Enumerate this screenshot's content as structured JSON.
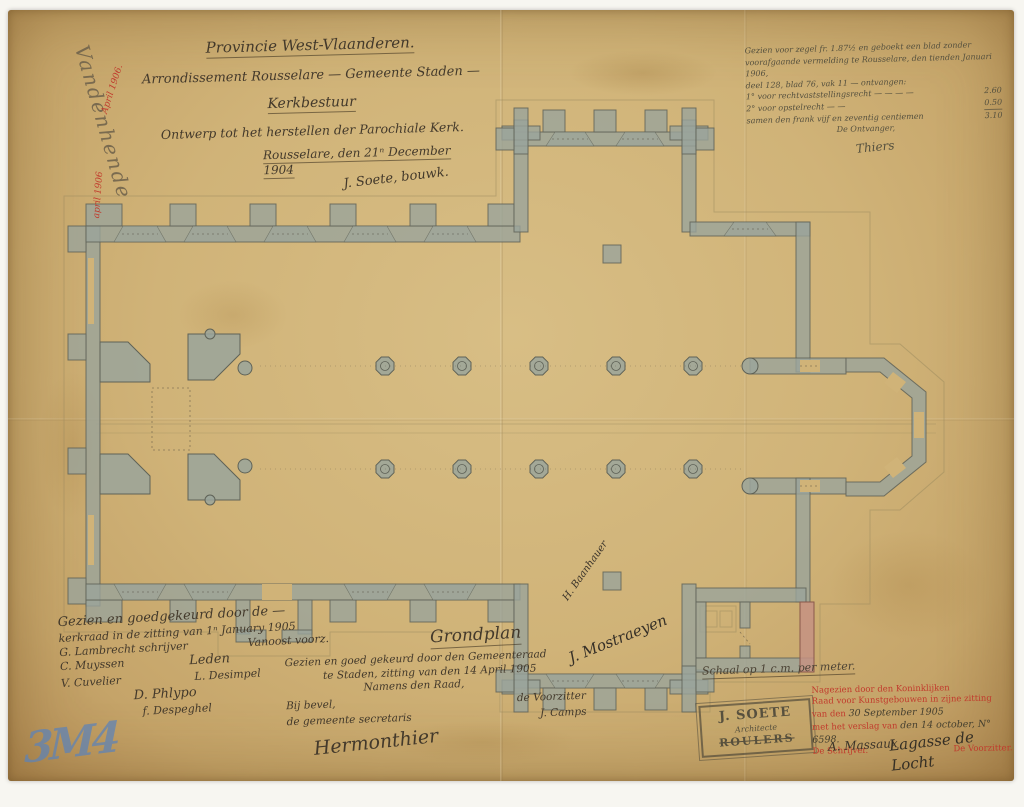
{
  "colors": {
    "paper": "#d0b378",
    "scan_border": "#f7f6f1",
    "wall_wash": "#9aa49b",
    "new_wall_red": "#c59282",
    "ink": "#43392b",
    "red_ink": "#c13a2c",
    "blue_crayon": "#5d83b8",
    "pencil": "#998a5e"
  },
  "title_block": {
    "province": "Provincie West-Vlaanderen.",
    "arrondissement": "Arrondissement Rousselare — Gemeente Staden —",
    "authority": "Kerkbestuur",
    "subject": "Ontwerp tot het herstellen der Parochiale Kerk.",
    "dateline": "Rousselare, den 21ⁿ December 1904",
    "architect_signature": "J. Soete, bouwk."
  },
  "registration_note": {
    "lines": [
      "Gezien voor zegel fr. 1.87½ en geboekt een blad zonder",
      "voorafgaande vermelding te Rousselare, den tienden Januari 1906,",
      "deel 128, blad 76, vak 11 — ontvangen:",
      "1° voor rechtvaststellingsrecht — — — —",
      "2° voor opstelrecht — —",
      "samen den frank vijf en zeventig centiemen",
      "De Ontvanger,"
    ],
    "amounts": [
      "2.60",
      "0.50",
      "3.10"
    ],
    "signature": "Thiers"
  },
  "margin_left": {
    "signature": "Vandenhende",
    "red_note_top": "April 1906.",
    "red_note_bottom": "april 1906",
    "blue_mark": "3M4"
  },
  "kerkraad_approval": {
    "line1": "Gezien en goedgekeurd door de —",
    "line2": "kerkraad in de zitting van 1ⁿ January 1905",
    "sig_schrijver": "G. Lambrecht schrijver",
    "sig_voorzitter": "Vanoost voorz.",
    "sig_3": "C. Muyssen",
    "label_leden": "Leden",
    "sig_4": "V. Cuvelier",
    "sig_5": "L. Desimpel",
    "sig_6": "D. Phlypo",
    "sig_7": "f. Despeghel"
  },
  "plan_title": "Grondplan",
  "gemeenteraad_approval": {
    "line1": "Gezien en goed gekeurd door den Gemeenteraad",
    "line2": "te Staden, zitting van den 14 April 1905",
    "line3": "Namens den Raad,",
    "label_voorzitter": "de Voorzitter",
    "sig_voorzitter": "J. Camps",
    "label_bevel": "Bij bevel,",
    "label_secretaris": "de gemeente secretaris",
    "sig_secretaris": "Hermonthier"
  },
  "plan_signatures": {
    "upper": "H. Baanhauer",
    "lower": "J. Mostraeyen"
  },
  "scale_note": "Schaal op 1 c.m. per meter.",
  "architect_stamp": {
    "name": "J. SOETE",
    "title": "Architecte",
    "city": "ROULERS"
  },
  "commission_stamp": {
    "line1": "Nagezien door den Koninklijken",
    "line2": "Raad voor Kunstgebouwen in zijne zitting",
    "line3_red": "van den",
    "line3_hand": "30 September 1905",
    "line4_red": "met het verslag van",
    "line4_hand": "den 14 october, N° 6598.",
    "line5_left": "De Schrijver.",
    "line5_right": "De Voorzitter.",
    "signature_left": "A. Massaux",
    "signature_right": "Lagasse de Locht"
  }
}
